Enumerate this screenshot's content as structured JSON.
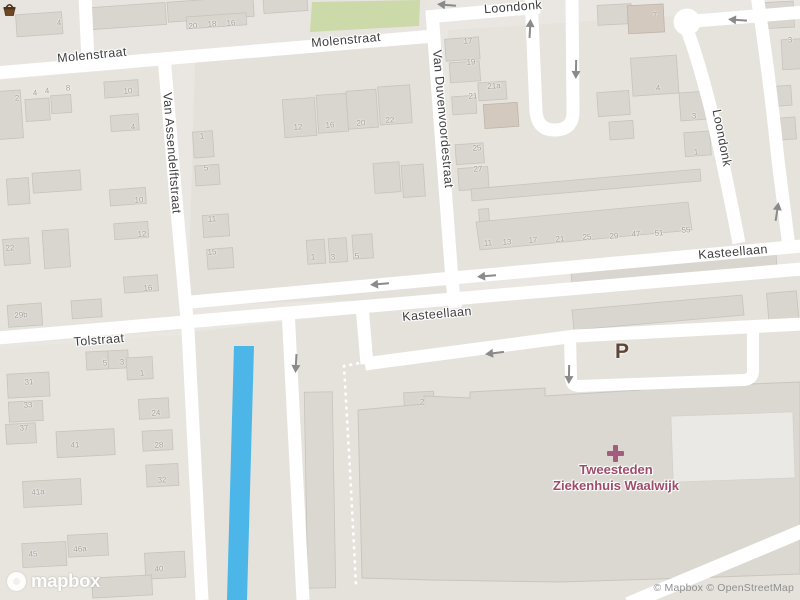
{
  "streets": [
    {
      "name": "Molenstraat",
      "x": 92,
      "y": 55,
      "rotate": -5.5
    },
    {
      "name": "Molenstraat",
      "x": 346,
      "y": 40,
      "rotate": -5
    },
    {
      "name": "Loondonk",
      "x": 513,
      "y": 7,
      "rotate": -4.5
    },
    {
      "name": "Loondonk",
      "x": 722,
      "y": 138,
      "rotate": 79
    },
    {
      "name": "Van Assendelftstraat",
      "x": 172,
      "y": 153,
      "rotate": 85.5
    },
    {
      "name": "Van Duvenvoordestraat",
      "x": 443,
      "y": 119,
      "rotate": 85
    },
    {
      "name": "Kasteellaan",
      "x": 437,
      "y": 314,
      "rotate": -5
    },
    {
      "name": "Kasteellaan",
      "x": 733,
      "y": 252,
      "rotate": -5
    },
    {
      "name": "Tolstraat",
      "x": 99,
      "y": 340,
      "rotate": -4.5
    }
  ],
  "house_numbers": [
    {
      "n": "4",
      "x": 59,
      "y": 23
    },
    {
      "n": "20",
      "x": 193,
      "y": 26
    },
    {
      "n": "18",
      "x": 212,
      "y": 24
    },
    {
      "n": "16",
      "x": 231,
      "y": 23
    },
    {
      "n": "2",
      "x": 17,
      "y": 98
    },
    {
      "n": "4",
      "x": 35,
      "y": 93
    },
    {
      "n": "4",
      "x": 47,
      "y": 91
    },
    {
      "n": "8",
      "x": 68,
      "y": 88
    },
    {
      "n": "10",
      "x": 128,
      "y": 91
    },
    {
      "n": "4",
      "x": 133,
      "y": 127
    },
    {
      "n": "12",
      "x": 298,
      "y": 127
    },
    {
      "n": "16",
      "x": 330,
      "y": 125
    },
    {
      "n": "20",
      "x": 361,
      "y": 123
    },
    {
      "n": "22",
      "x": 390,
      "y": 120
    },
    {
      "n": "1",
      "x": 202,
      "y": 136
    },
    {
      "n": "5",
      "x": 206,
      "y": 168
    },
    {
      "n": "11",
      "x": 212,
      "y": 219
    },
    {
      "n": "15",
      "x": 212,
      "y": 252
    },
    {
      "n": "10",
      "x": 139,
      "y": 200
    },
    {
      "n": "12",
      "x": 142,
      "y": 234
    },
    {
      "n": "16",
      "x": 148,
      "y": 288
    },
    {
      "n": "22",
      "x": 10,
      "y": 248
    },
    {
      "n": "29b",
      "x": 21,
      "y": 315
    },
    {
      "n": "1",
      "x": 313,
      "y": 257
    },
    {
      "n": "3",
      "x": 333,
      "y": 257
    },
    {
      "n": "5",
      "x": 357,
      "y": 256
    },
    {
      "n": "17",
      "x": 468,
      "y": 41
    },
    {
      "n": "19",
      "x": 471,
      "y": 62
    },
    {
      "n": "21a",
      "x": 494,
      "y": 86
    },
    {
      "n": "21",
      "x": 473,
      "y": 96
    },
    {
      "n": "25",
      "x": 477,
      "y": 148
    },
    {
      "n": "27",
      "x": 478,
      "y": 169
    },
    {
      "n": "7",
      "x": 655,
      "y": 15
    },
    {
      "n": "4",
      "x": 658,
      "y": 88
    },
    {
      "n": "3",
      "x": 694,
      "y": 116
    },
    {
      "n": "1",
      "x": 696,
      "y": 152
    },
    {
      "n": "3",
      "x": 790,
      "y": 40
    },
    {
      "n": "11",
      "x": 488,
      "y": 243
    },
    {
      "n": "13",
      "x": 507,
      "y": 242
    },
    {
      "n": "17",
      "x": 533,
      "y": 240
    },
    {
      "n": "21",
      "x": 560,
      "y": 239
    },
    {
      "n": "25",
      "x": 587,
      "y": 237
    },
    {
      "n": "29",
      "x": 614,
      "y": 236
    },
    {
      "n": "47",
      "x": 636,
      "y": 234
    },
    {
      "n": "51",
      "x": 659,
      "y": 233
    },
    {
      "n": "55",
      "x": 686,
      "y": 230
    },
    {
      "n": "2",
      "x": 422,
      "y": 402
    },
    {
      "n": "31",
      "x": 29,
      "y": 382
    },
    {
      "n": "33",
      "x": 28,
      "y": 405
    },
    {
      "n": "37",
      "x": 24,
      "y": 428
    },
    {
      "n": "41",
      "x": 75,
      "y": 445
    },
    {
      "n": "41a",
      "x": 38,
      "y": 492
    },
    {
      "n": "5",
      "x": 105,
      "y": 363
    },
    {
      "n": "3",
      "x": 122,
      "y": 362
    },
    {
      "n": "1",
      "x": 142,
      "y": 373
    },
    {
      "n": "24",
      "x": 156,
      "y": 413
    },
    {
      "n": "28",
      "x": 159,
      "y": 445
    },
    {
      "n": "32",
      "x": 162,
      "y": 480
    },
    {
      "n": "45",
      "x": 33,
      "y": 554
    },
    {
      "n": "46a",
      "x": 80,
      "y": 549
    },
    {
      "n": "40",
      "x": 159,
      "y": 569
    }
  ],
  "oneway_arrows": [
    {
      "x": 447,
      "y": 5,
      "angle": 185
    },
    {
      "x": 738,
      "y": 20,
      "angle": 184
    },
    {
      "x": 530,
      "y": 29,
      "angle": -87
    },
    {
      "x": 576,
      "y": 69,
      "angle": 91
    },
    {
      "x": 777,
      "y": 212,
      "angle": -81
    },
    {
      "x": 380,
      "y": 284,
      "angle": 175
    },
    {
      "x": 487,
      "y": 276,
      "angle": 175
    },
    {
      "x": 495,
      "y": 353,
      "angle": 173
    },
    {
      "x": 569,
      "y": 374,
      "angle": 91
    },
    {
      "x": 296,
      "y": 363,
      "angle": 93
    }
  ],
  "pois": {
    "hospital": {
      "line1": "Tweesteden",
      "line2": "Ziekenhuis Waalwijk",
      "color": "#9e4c68",
      "icon": "hospital-cross"
    },
    "parking": {
      "label": "P",
      "color": "#5d4537"
    },
    "shop": {
      "icon": "shopping-basket"
    }
  },
  "attribution": {
    "logo": "mapbox",
    "text": "© Mapbox © OpenStreetMap"
  },
  "colors": {
    "background": "#eae7e2",
    "road": "#ffffff",
    "water": "#4db6e8",
    "park": "#ccd9a9",
    "building": "#d9d5cf",
    "building_outline": "#c7c3bd",
    "building_tan": "#d3c9bf",
    "hospital_building": "#dbd7d1",
    "street_label": "#3f3f3f",
    "house_number": "#a29e97",
    "arrow": "#8a8a8a"
  }
}
